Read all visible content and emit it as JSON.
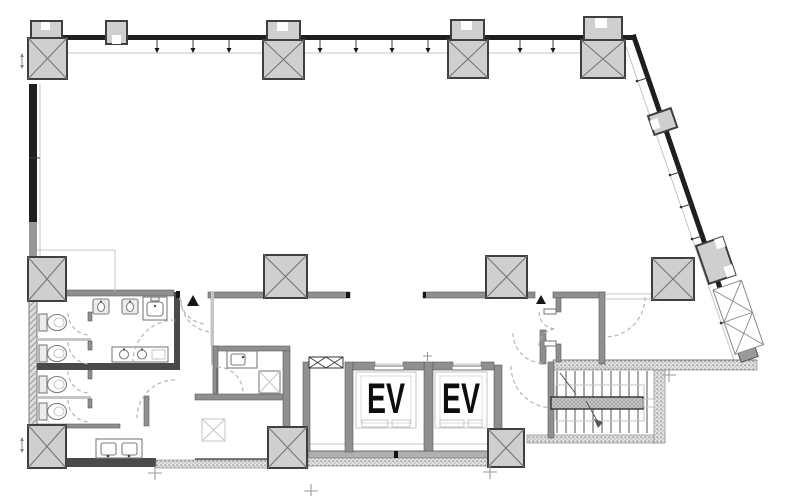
{
  "plan": {
    "elevators": {
      "labels": [
        "EV",
        "EV"
      ]
    },
    "colors": {
      "background": "#ffffff",
      "wall": "#1f1f1f",
      "interior-wall": "#8f8f8f",
      "interior-wall-dark": "#4a4a4a",
      "column-fill": "#cfcfcf",
      "column-border": "#3f3f3f",
      "brace": "#767676",
      "light-line": "#c6c6c6",
      "fixture": "#7d7d7d",
      "door-arc": "#b5b5b5",
      "stair-line": "#565656",
      "label-text": "#0e0e0e"
    }
  }
}
